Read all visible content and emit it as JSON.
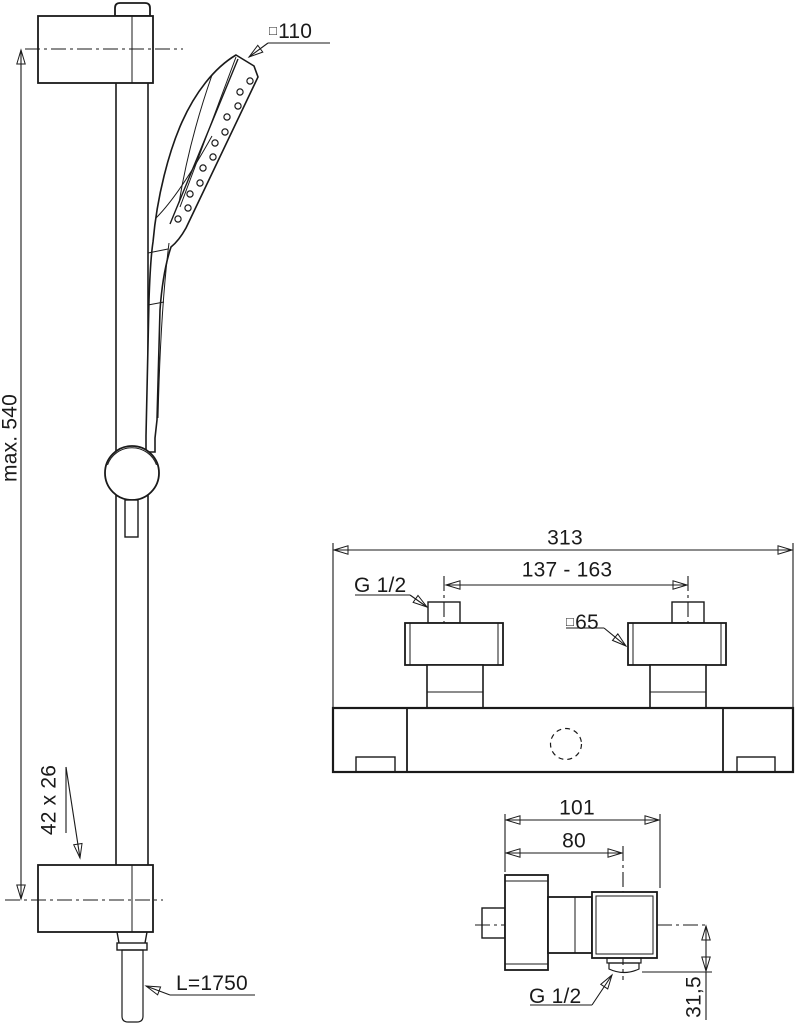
{
  "colors": {
    "line": "#1a1a1a",
    "hose_fill": "#a7a7a7",
    "background": "#ffffff"
  },
  "shower_rail_view": {
    "head_size": {
      "symbol": "□",
      "value": "110"
    },
    "rail_height": "max. 540",
    "bracket_size": "42 x 26",
    "hose_length": "L=1750"
  },
  "mixer_front_view": {
    "overall_width": "313",
    "inlet_centers_range": "137 - 163",
    "inlet_thread": "G 1/2",
    "escutcheon_size": {
      "symbol": "□",
      "value": "65"
    }
  },
  "mixer_side_view": {
    "overall_depth": "101",
    "outlet_center_depth": "80",
    "outlet_thread": "G 1/2",
    "outlet_drop": "31,5"
  }
}
